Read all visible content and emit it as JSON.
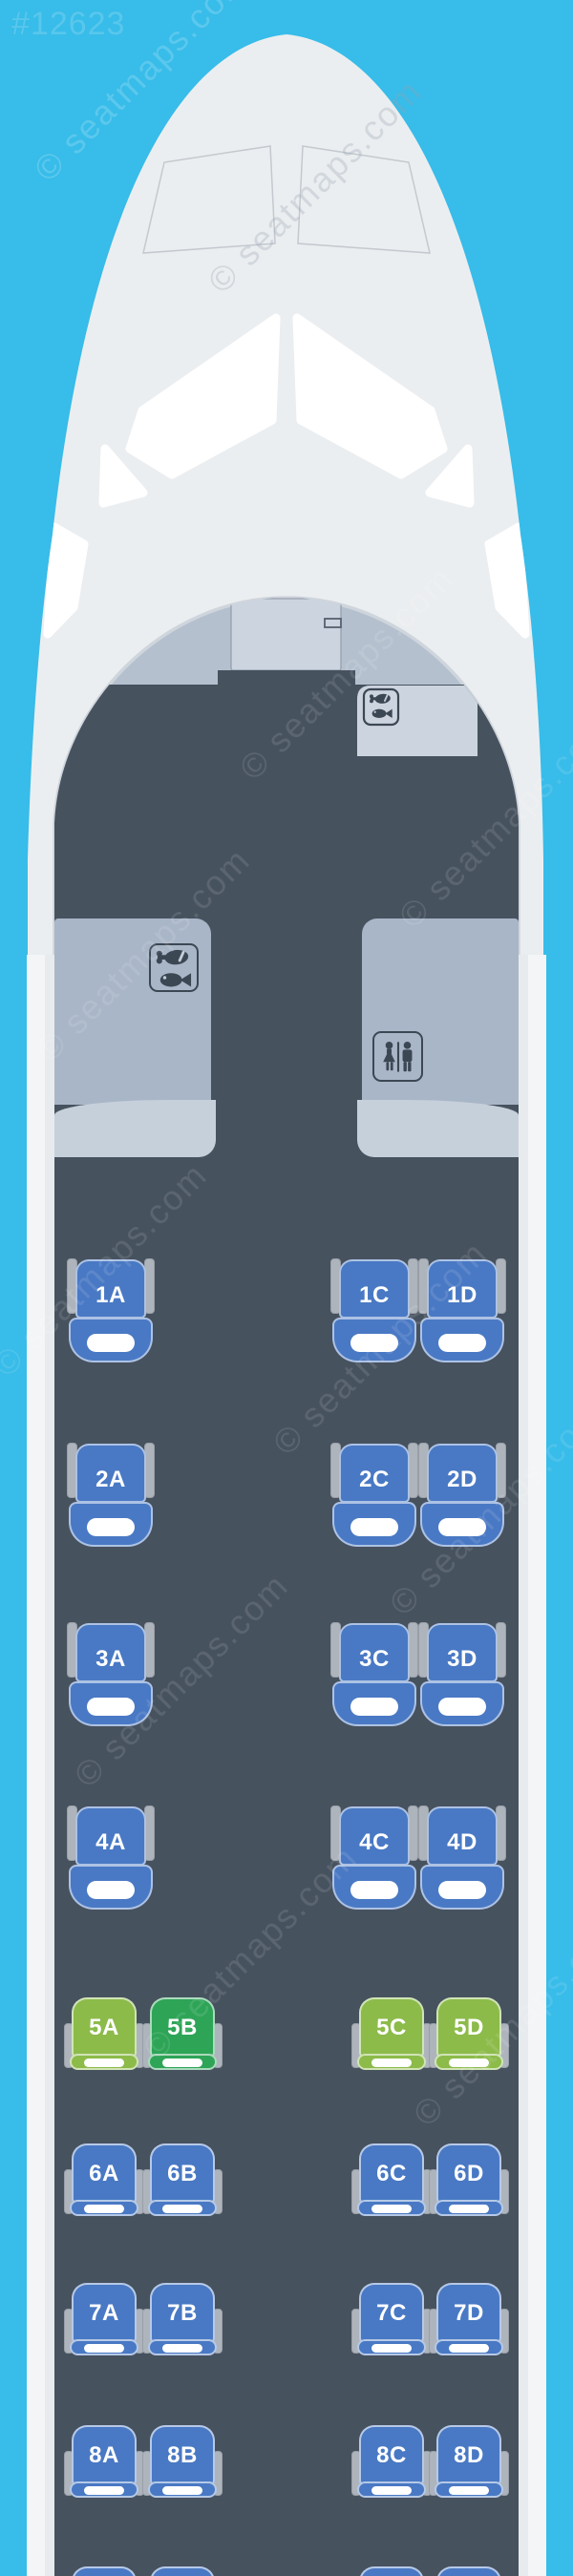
{
  "page": {
    "map_id": "#12623",
    "watermark_text": "© seatmaps.com"
  },
  "aircraft": {
    "front_monuments": {
      "left": "galley",
      "right": "lavatory",
      "door_side_right": "galley"
    }
  },
  "colors": {
    "background": "#38bce9",
    "fuselage": "#ebeef0",
    "cabin_floor": "#47525f",
    "bulkhead": "#b4c0ce",
    "door_panel": "#ccd4df",
    "monument": "#a9b6c7",
    "monument_band": "#c6d0db",
    "icon": "#3c4754",
    "seat_blue": "#4979c4",
    "seat_green_light": "#8cbb4a",
    "seat_green_dark": "#2ea457",
    "armrest": "#aeb4bc",
    "cushion_white": "#ffffff"
  },
  "cabin": {
    "rows": [
      {
        "row": "1",
        "class": "first",
        "seats": [
          {
            "id": "1A",
            "color": "blue"
          },
          {
            "id": "1C",
            "color": "blue"
          },
          {
            "id": "1D",
            "color": "blue"
          }
        ]
      },
      {
        "row": "2",
        "class": "first",
        "seats": [
          {
            "id": "2A",
            "color": "blue"
          },
          {
            "id": "2C",
            "color": "blue"
          },
          {
            "id": "2D",
            "color": "blue"
          }
        ]
      },
      {
        "row": "3",
        "class": "first",
        "seats": [
          {
            "id": "3A",
            "color": "blue"
          },
          {
            "id": "3C",
            "color": "blue"
          },
          {
            "id": "3D",
            "color": "blue"
          }
        ]
      },
      {
        "row": "4",
        "class": "first",
        "seats": [
          {
            "id": "4A",
            "color": "blue"
          },
          {
            "id": "4C",
            "color": "blue"
          },
          {
            "id": "4D",
            "color": "blue"
          }
        ]
      },
      {
        "row": "5",
        "class": "economy",
        "seats": [
          {
            "id": "5A",
            "color": "green_light"
          },
          {
            "id": "5B",
            "color": "green_dark"
          },
          {
            "id": "5C",
            "color": "green_light"
          },
          {
            "id": "5D",
            "color": "green_light"
          }
        ]
      },
      {
        "row": "6",
        "class": "economy",
        "seats": [
          {
            "id": "6A",
            "color": "blue"
          },
          {
            "id": "6B",
            "color": "blue"
          },
          {
            "id": "6C",
            "color": "blue"
          },
          {
            "id": "6D",
            "color": "blue"
          }
        ]
      },
      {
        "row": "7",
        "class": "economy",
        "seats": [
          {
            "id": "7A",
            "color": "blue"
          },
          {
            "id": "7B",
            "color": "blue"
          },
          {
            "id": "7C",
            "color": "blue"
          },
          {
            "id": "7D",
            "color": "blue"
          }
        ]
      },
      {
        "row": "8",
        "class": "economy",
        "seats": [
          {
            "id": "8A",
            "color": "blue"
          },
          {
            "id": "8B",
            "color": "blue"
          },
          {
            "id": "8C",
            "color": "blue"
          },
          {
            "id": "8D",
            "color": "blue"
          }
        ]
      },
      {
        "row": "9",
        "class": "economy",
        "partially_visible": true,
        "seats": [
          {
            "id": "",
            "color": "blue"
          },
          {
            "id": "",
            "color": "blue"
          },
          {
            "id": "",
            "color": "blue"
          },
          {
            "id": "",
            "color": "blue"
          }
        ]
      }
    ]
  }
}
